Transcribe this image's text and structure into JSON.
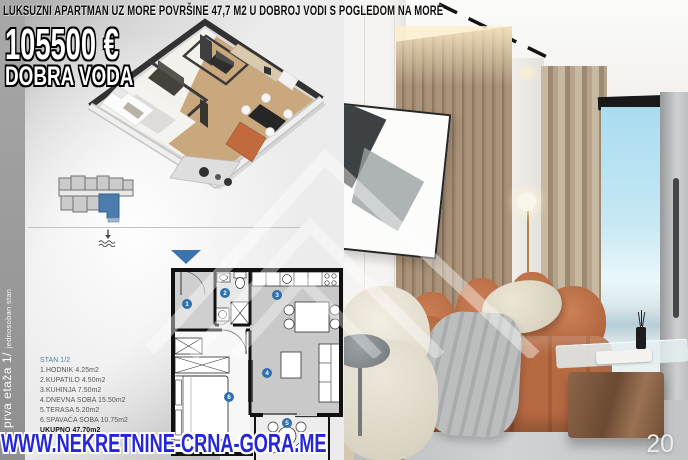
{
  "header": {
    "title": "LUKSUZNI APARTMAN UZ MORE POVRŠINE 47,7 M2 U DOBROJ VODI S POGLEDOM NA MORE",
    "price": "105500 €",
    "location": "DOBRA VODA"
  },
  "side_label": {
    "floor": "prva etaža 1/",
    "unit_type": "jednosoban stan"
  },
  "unit_info": {
    "unit": "STAN 1/2",
    "rooms": [
      "1.HODNIK 4.25m2",
      "2.KUPATILO 4.50m2",
      "3.KUHINJA 7.50m2",
      "4.DNEVNA SOBA 15.50m2",
      "5.TERASA 5.20m2",
      "6.SPAVAĆA SOBA 10.75m2"
    ],
    "total": "UKUPNO 47.70m2"
  },
  "floor_plan": {
    "room_numbers": [
      "1",
      "2",
      "3",
      "4",
      "5",
      "6"
    ]
  },
  "footer": {
    "watermark": "WWW.NEKRETNINE-CRNA-GORA.ME",
    "page_number": "20"
  },
  "colors": {
    "accent_blue": "#2f6fae",
    "watermark_blue": "#2526d8",
    "highlighted_unit_blue": "#4b7cab",
    "sofa_orange": "#bd7048"
  }
}
